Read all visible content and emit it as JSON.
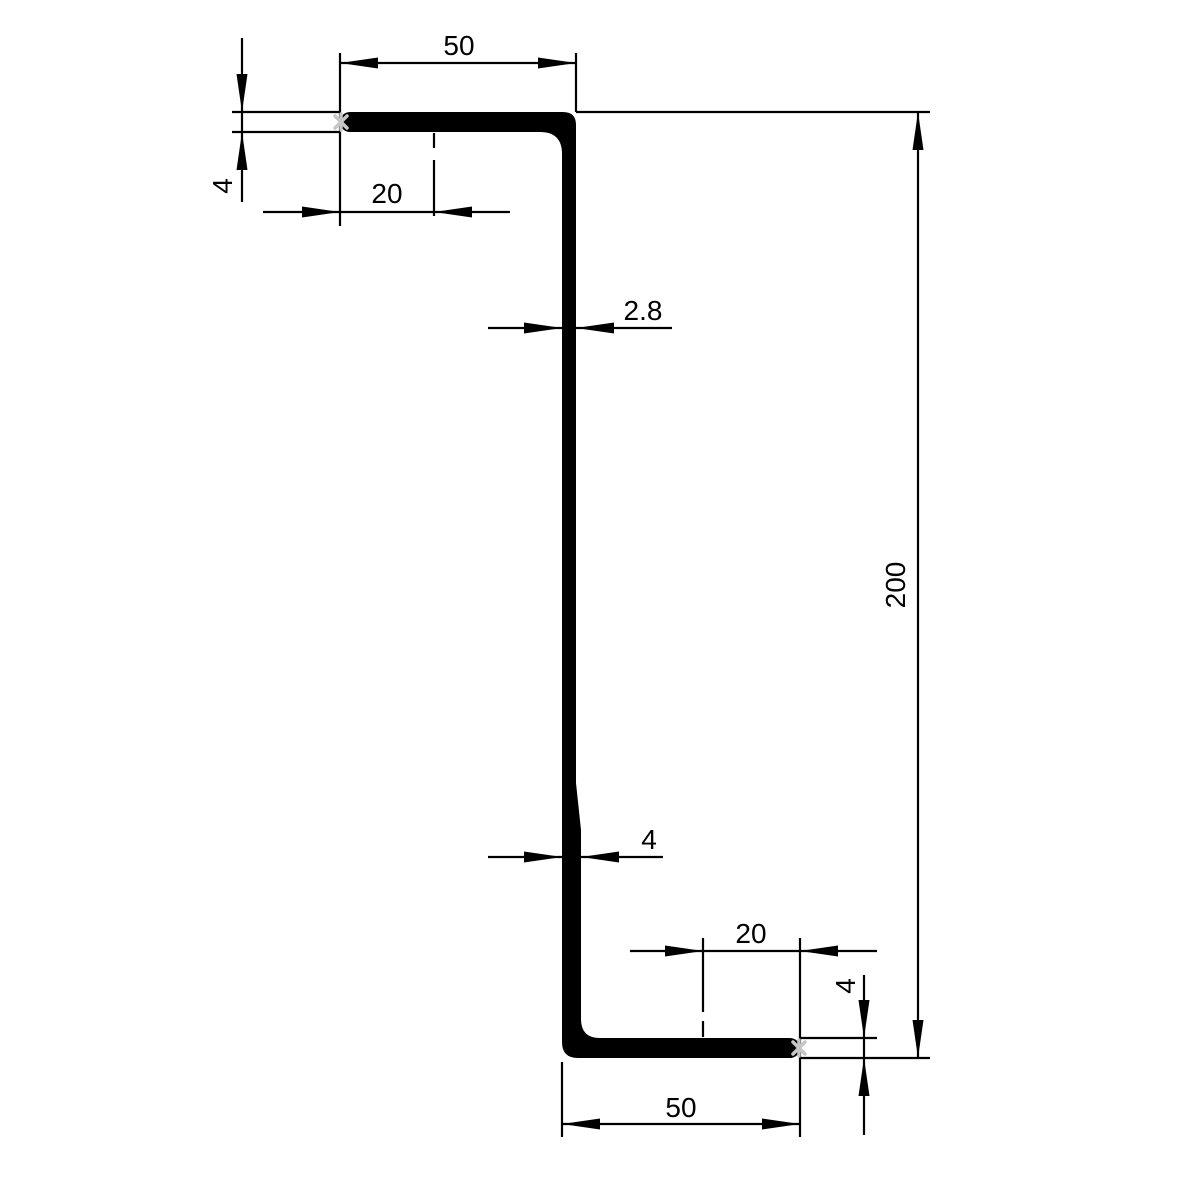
{
  "drawing": {
    "kind": "z-profile-cross-section-technical-drawing",
    "dims": {
      "top_flange_width": "50",
      "top_flange_thickness": "4",
      "top_lip_offset": "20",
      "web_thickness_upper": "2.8",
      "overall_height": "200",
      "web_thickness_lower": "4",
      "bottom_lip_offset": "20",
      "bottom_flange_thickness": "4",
      "bottom_flange_width": "50"
    },
    "colors": {
      "line": "#000000",
      "marker": "#c6c6c6",
      "background": "#ffffff"
    }
  }
}
